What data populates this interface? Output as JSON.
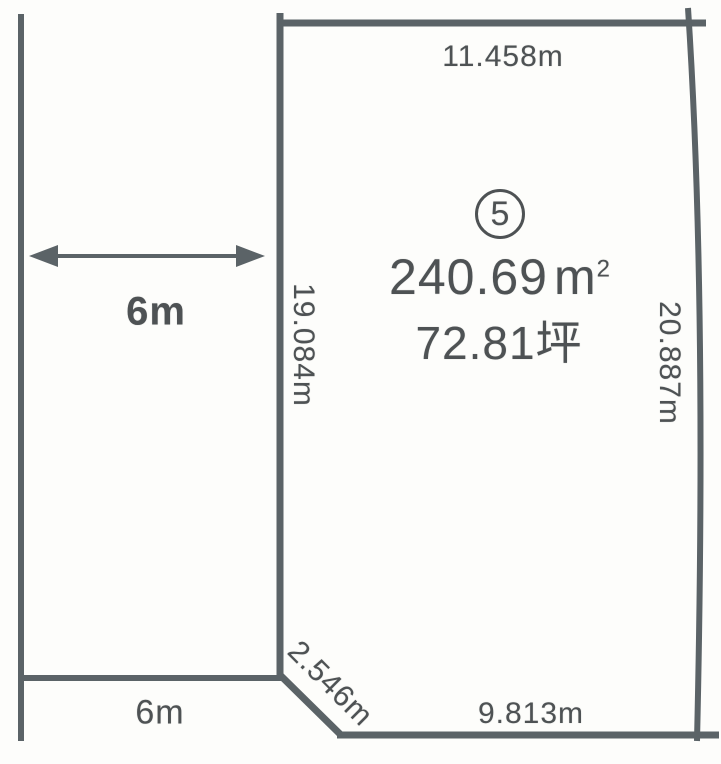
{
  "diagram": {
    "lot": {
      "number": "5",
      "area_sqm_value": "240.69",
      "area_sqm_unit": "m",
      "area_sqm_exponent": "2",
      "area_tsubo": "72.81坪"
    },
    "dimensions": {
      "top_edge": "11.458m",
      "left_edge": "19.084m",
      "right_edge": "20.887m",
      "bottom_edge": "9.813m",
      "corner_cut": "2.546m",
      "road_width": "6m",
      "road_frontage": "6m"
    },
    "colors": {
      "line": "#5b6367",
      "text": "#4e5254",
      "background": "#fdfdfb"
    }
  }
}
